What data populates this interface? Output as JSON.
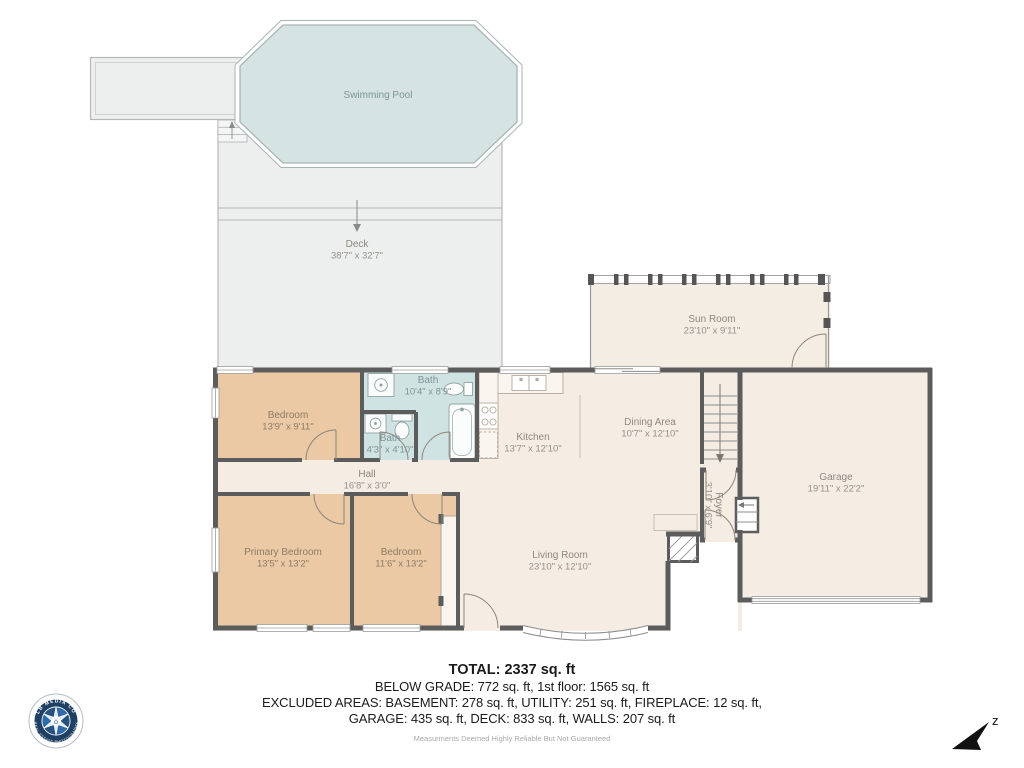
{
  "rooms": {
    "swimming_pool": {
      "name": "Swimming Pool",
      "dims": ""
    },
    "deck": {
      "name": "Deck",
      "dims": "38'7\" x 32'7\""
    },
    "sun_room": {
      "name": "Sun Room",
      "dims": "23'10\" x 9'11\""
    },
    "bedroom_top": {
      "name": "Bedroom",
      "dims": "13'9\" x 9'11\""
    },
    "bath_main": {
      "name": "Bath",
      "dims": "10'4\" x 8'9\""
    },
    "bath_small": {
      "name": "Bath",
      "dims": "4'3\" x 4'10\""
    },
    "hall": {
      "name": "Hall",
      "dims": "16'8\" x 3'0\""
    },
    "kitchen": {
      "name": "Kitchen",
      "dims": "13'7\" x 12'10\""
    },
    "dining": {
      "name": "Dining Area",
      "dims": "10'7\" x 12'10\""
    },
    "foyer": {
      "name": "Foyer",
      "dims": "3'10\" x 6'9\""
    },
    "garage": {
      "name": "Garage",
      "dims": "19'11\" x 22'2\""
    },
    "primary_bedroom": {
      "name": "Primary Bedroom",
      "dims": "13'5\" x 13'2\""
    },
    "bedroom_bottom": {
      "name": "Bedroom",
      "dims": "11'6\" x 13'2\""
    },
    "living_room": {
      "name": "Living Room",
      "dims": "23'10\" x 12'10\""
    }
  },
  "summary": {
    "total": "TOTAL: 2337 sq. ft",
    "line2": "BELOW GRADE: 772 sq. ft, 1st floor: 1565 sq. ft",
    "line3": "EXCLUDED AREAS: BASEMENT: 278 sq. ft, UTILITY: 251 sq. ft, FIREPLACE: 12 sq. ft,",
    "line4": "GARAGE: 435 sq. ft, DECK: 833 sq. ft, WALLS: 207 sq. ft",
    "disclaimer": "Measurments Deemed Highly Reliable But Not Guaranteed"
  },
  "compass": {
    "label": "z"
  },
  "logo": {
    "top_text": "LB MEDIA CO",
    "bottom_text": "REAL ESTATE PHOTOGRAPHY",
    "house_glyph": "⌂"
  },
  "colors": {
    "wall": "#5c5c5c",
    "deck_fill": "#edefee",
    "pool_fill": "#d5e3e3",
    "room_fill": "#f5ede4",
    "bedroom_fill": "#ebc9a4",
    "bath_fill": "#d0e3e3",
    "logo_navy": "#1f3f63",
    "logo_blue": "#2f6ba8"
  }
}
